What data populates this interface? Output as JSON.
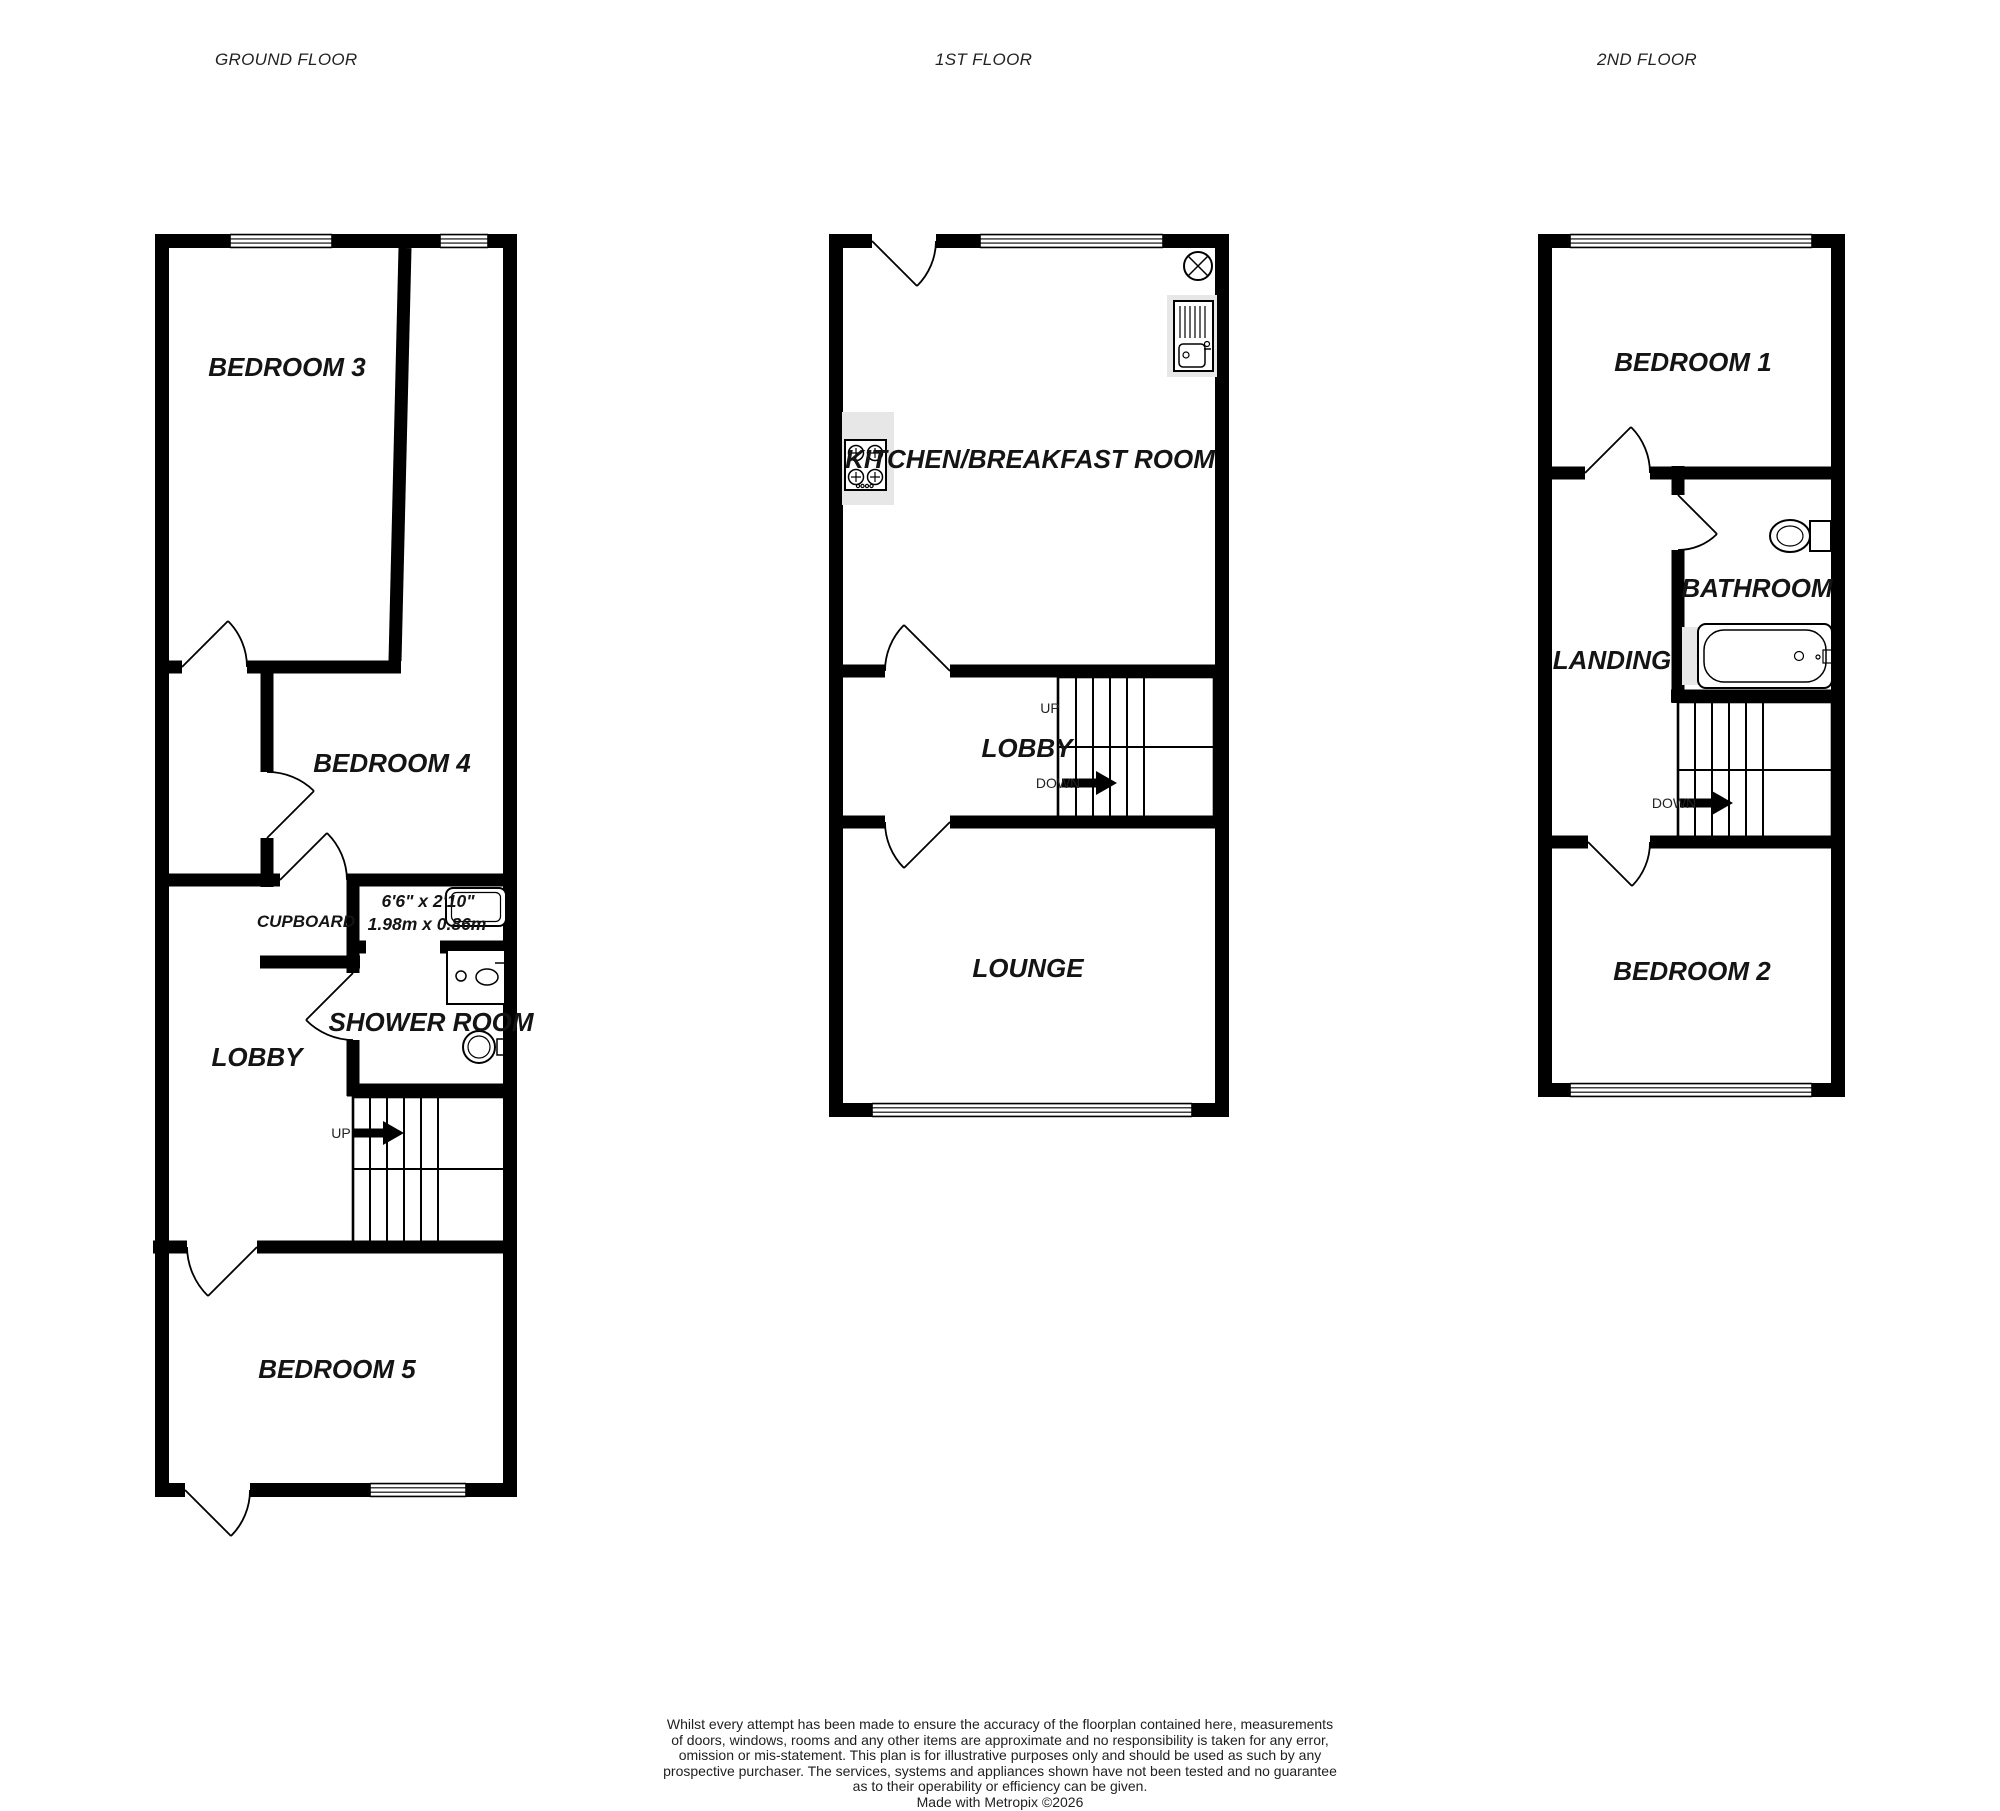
{
  "colors": {
    "wall": "#000000",
    "background": "#ffffff",
    "fixture_gray": "#e7e7e7"
  },
  "floors": {
    "ground": {
      "title": "GROUND FLOOR",
      "bedroom3": "BEDROOM 3",
      "bedroom4": "BEDROOM 4",
      "cupboard": "CUPBOARD",
      "shower_room": "SHOWER ROOM",
      "shower_dims_imperial": "6'6\"  x 2'10\"",
      "shower_dims_metric": "1.98m  x 0.86m",
      "lobby": "LOBBY",
      "up": "UP",
      "bedroom5": "BEDROOM 5"
    },
    "first": {
      "title": "1ST FLOOR",
      "kitchen": "KITCHEN/BREAKFAST ROOM",
      "up": "UP",
      "lobby": "LOBBY",
      "down": "DOWN",
      "lounge": "LOUNGE"
    },
    "second": {
      "title": "2ND FLOOR",
      "bedroom1": "BEDROOM 1",
      "bathroom": "BATHROOM",
      "landing": "LANDING",
      "down": "DOWN",
      "bedroom2": "BEDROOM 2"
    }
  },
  "footer": {
    "lines": [
      "Whilst every attempt has been made to ensure the accuracy of the floorplan contained here, measurements",
      "of doors, windows, rooms and any other items are approximate and no responsibility is taken for any error,",
      "omission or mis-statement. This plan is for illustrative purposes only and should be used as such by any",
      "prospective purchaser. The services, systems and appliances shown have not been tested and no guarantee",
      "as to their operability or efficiency can be given."
    ],
    "credit": "Made with Metropix ©2026"
  }
}
